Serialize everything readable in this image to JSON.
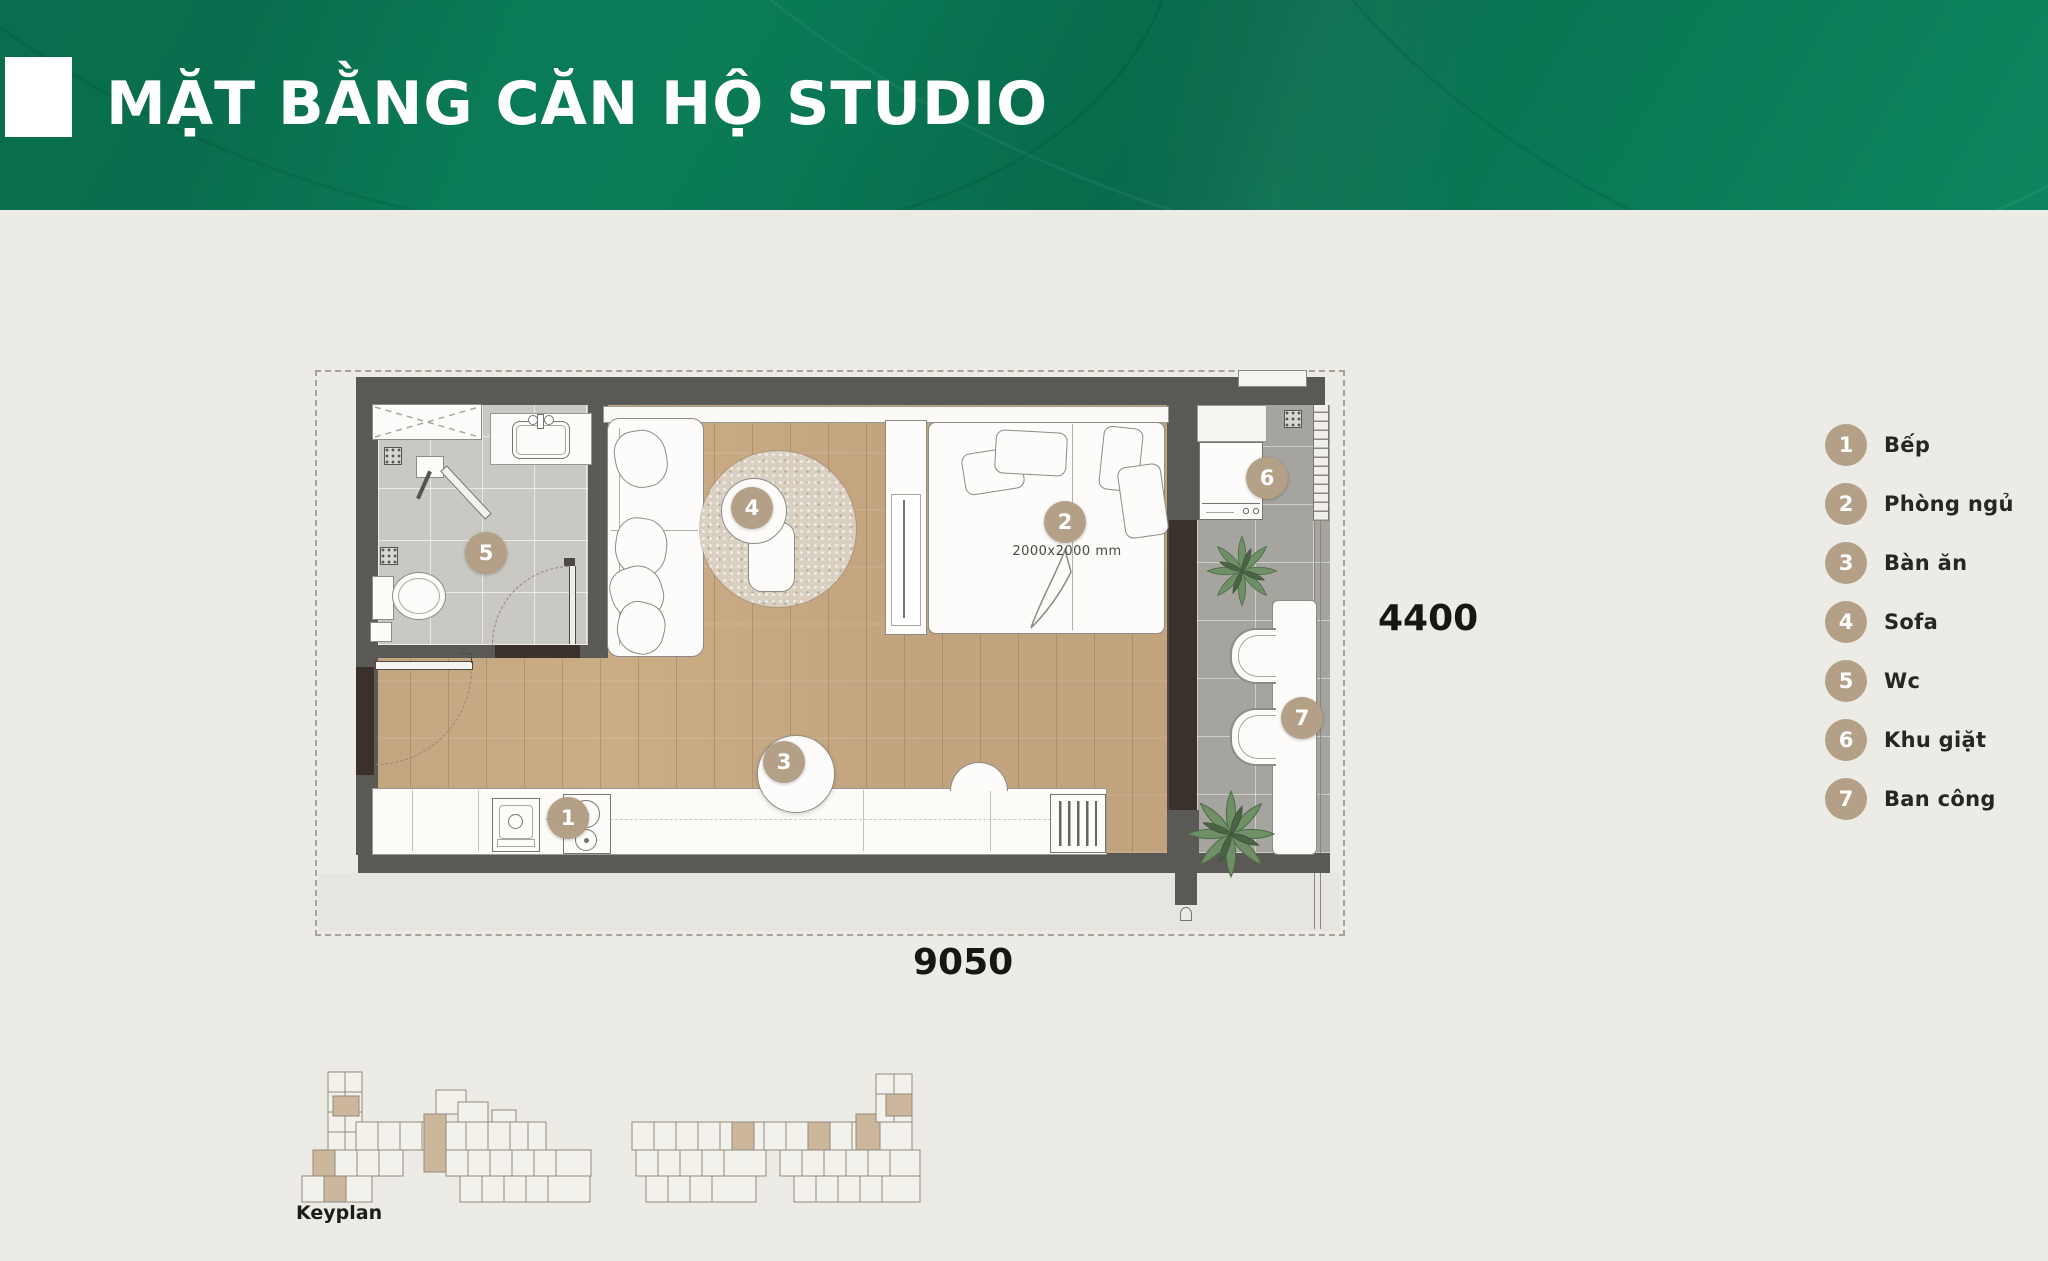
{
  "header": {
    "title": "MẶT BẰNG CĂN HỘ STUDIO"
  },
  "colors": {
    "banner_green": "#0a7a57",
    "marker_tan": "#b3a087",
    "wall_gray": "#5b5955",
    "wood_floor": "#cbac85",
    "bath_tile": "#cac8c2",
    "balcony_tile": "#a6a49e",
    "door_brown": "#3a322a",
    "page_bg": "#edebe6"
  },
  "plan": {
    "markers": [
      "1",
      "2",
      "3",
      "4",
      "5",
      "6",
      "7"
    ],
    "bed_size_label": "2000x2000 mm",
    "dim_bottom": "9050",
    "dim_right": "4400"
  },
  "legend": {
    "items": [
      {
        "num": "1",
        "label": "Bếp"
      },
      {
        "num": "2",
        "label": "Phòng ngủ"
      },
      {
        "num": "3",
        "label": "Bàn ăn"
      },
      {
        "num": "4",
        "label": "Sofa"
      },
      {
        "num": "5",
        "label": "Wc"
      },
      {
        "num": "6",
        "label": "Khu giặt"
      },
      {
        "num": "7",
        "label": "Ban công"
      }
    ]
  },
  "keyplan": {
    "label": "Keyplan"
  }
}
